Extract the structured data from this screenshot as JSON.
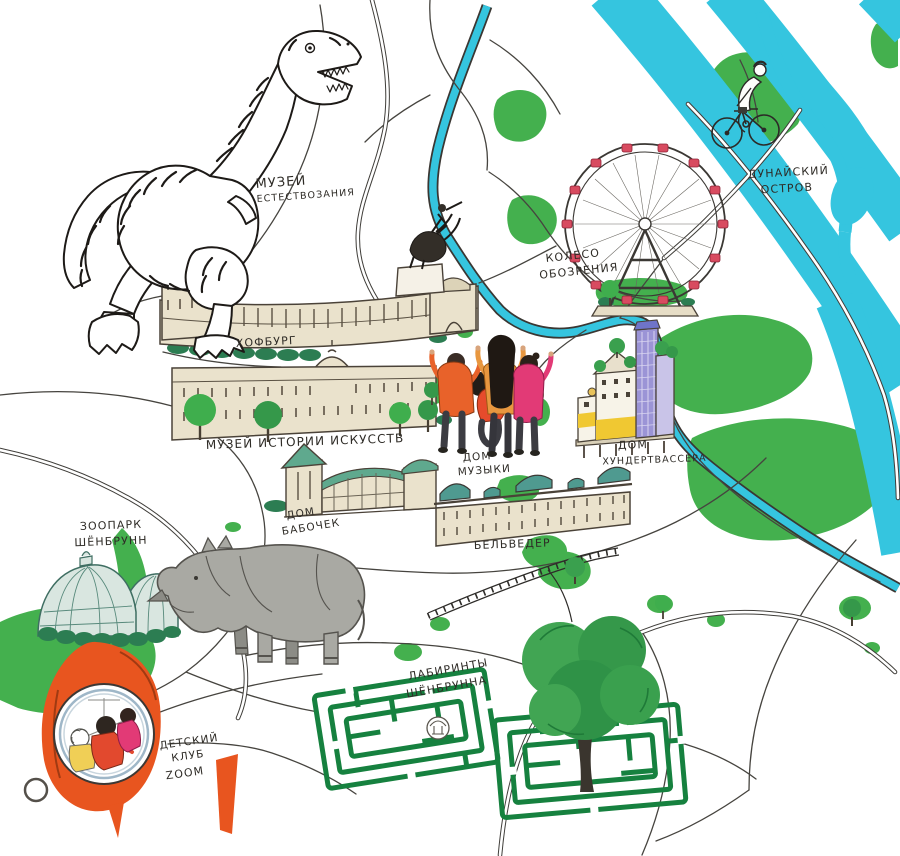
{
  "map": {
    "description": "Hand-drawn illustrated map of Vienna attractions with Russian hand-lettered labels, cyan rivers, green parks and sketched roads"
  },
  "labels": {
    "natural_history_museum": {
      "line1": "МУЗЕЙ",
      "line2": "ЕСТЕСТВОЗАНИЯ"
    },
    "hofburg": {
      "line1": "ХОФБУРГ"
    },
    "art_history_museum": {
      "line1": "МУЗЕЙ ИСТОРИИ ИСКУССТВ"
    },
    "ferris_wheel": {
      "line1": "КОЛЕСО",
      "line2": "ОБОЗРЕНИЯ"
    },
    "danube_island": {
      "line1": "ДУНАЙСКИЙ",
      "line2": "ОСТРОВ"
    },
    "hundertwasser_house": {
      "line1": "ДОМ",
      "line2": "ХУНДЕРТВАССЕРА"
    },
    "house_of_music": {
      "line1": "ДОМ",
      "line2": "МУЗЫКИ"
    },
    "butterfly_house": {
      "line1": "ДОМ",
      "line2": "БАБОЧЕК"
    },
    "belvedere": {
      "line1": "БЕЛЬВЕДЕР"
    },
    "schoenbrunn_zoo": {
      "line1": "ЗООПАРК",
      "line2": "ШЁНБРУНН"
    },
    "schoenbrunn_labyrinths": {
      "line1": "ЛАБИРИНТЫ",
      "line2": "ШЁНБРУННА"
    },
    "kids_club_zoom": {
      "line1": "ДЕТСКИЙ",
      "line2": "КЛУБ",
      "line3": "ZOOM"
    }
  },
  "illustrations": [
    "dinosaur-sketch",
    "equestrian-statue",
    "hofburg-palace",
    "art-history-museum-building",
    "butterfly-house-greenhouse",
    "belvedere-palace",
    "palm-house-greenhouse",
    "hundertwasser-house",
    "ferris-wheel",
    "cyclist-on-danube-island",
    "family-looking-at-map",
    "rhinoceros",
    "washing-machine-porthole-with-children",
    "hedge-maze-left",
    "hedge-maze-right",
    "large-tree"
  ],
  "colors": {
    "river": "#35c5df",
    "park": "#44b04e",
    "dark_hedge": "#2c7d52",
    "maze_green": "#16813f",
    "building_cream": "#eae2cc",
    "dome_teal": "#4f9a90",
    "roof_green": "#5fa98e",
    "machine_orange": "#e8551f",
    "cabin_red": "#d84b60",
    "rhino_gray": "#a9a9a3",
    "jacket_orange": "#e8622a",
    "jacket_pink": "#e23a76",
    "shirt_red": "#e64b2c",
    "top_ochre": "#e8973f",
    "hundertwasser_yellow": "#f0c832",
    "hundertwasser_purple": "#9b94d6",
    "ink": "#2e2b26"
  }
}
